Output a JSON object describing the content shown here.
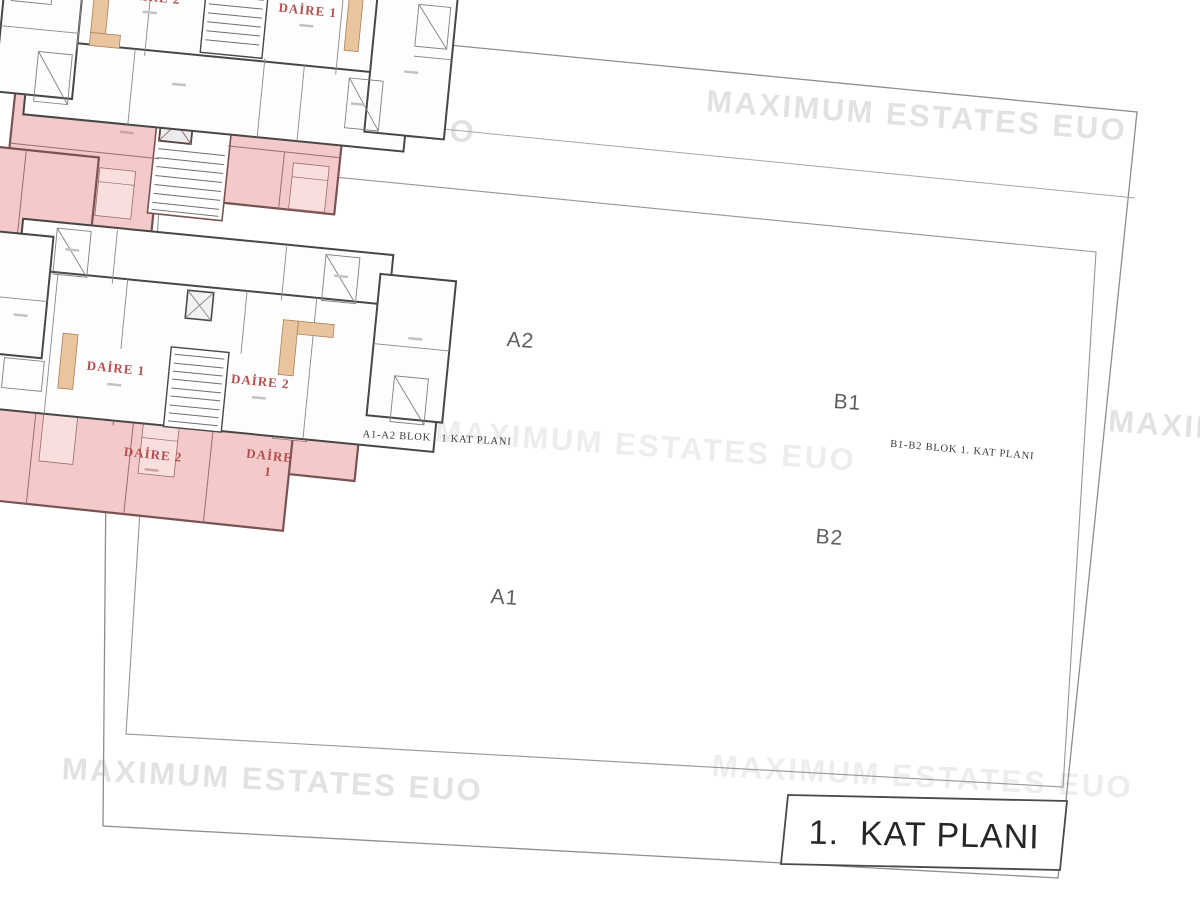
{
  "watermark": {
    "text": "MAXIMUM ESTATES EUO"
  },
  "title_block": {
    "text": "1.  KAT PLANI"
  },
  "captions": {
    "a_blok": "A1-A2 BLOK   1 KAT PLANI",
    "b_blok": "B1-B2 BLOK 1. KAT PLANI"
  },
  "block_labels": {
    "a2": "A2",
    "a1": "A1",
    "b1": "B1",
    "b2": "B2"
  },
  "units": {
    "a2": {
      "u1": "DAİRE 2",
      "u2": "DAİRE 3",
      "u3": "DAİRE 1"
    },
    "a1": {
      "u1": "DAİRE 3",
      "u2": "DAİRE 2",
      "u3_line1": "DAİRE",
      "u3_line2": "1"
    },
    "b1": {
      "u1": "DAİRE 2",
      "u2": "DAİRE 1"
    },
    "b2": {
      "u1": "DAİRE 1",
      "u2": "DAİRE 2"
    }
  },
  "colors": {
    "plan_pink": "#f4c9c9",
    "pink_wall": "#7a5252",
    "white_plan_wall": "#474747",
    "unit_label_red": "#b44f4f",
    "kitchen_tan": "#e9c49c",
    "watermark_gray": "#e2e2e2",
    "page_border_gray": "#8e8e8e"
  }
}
